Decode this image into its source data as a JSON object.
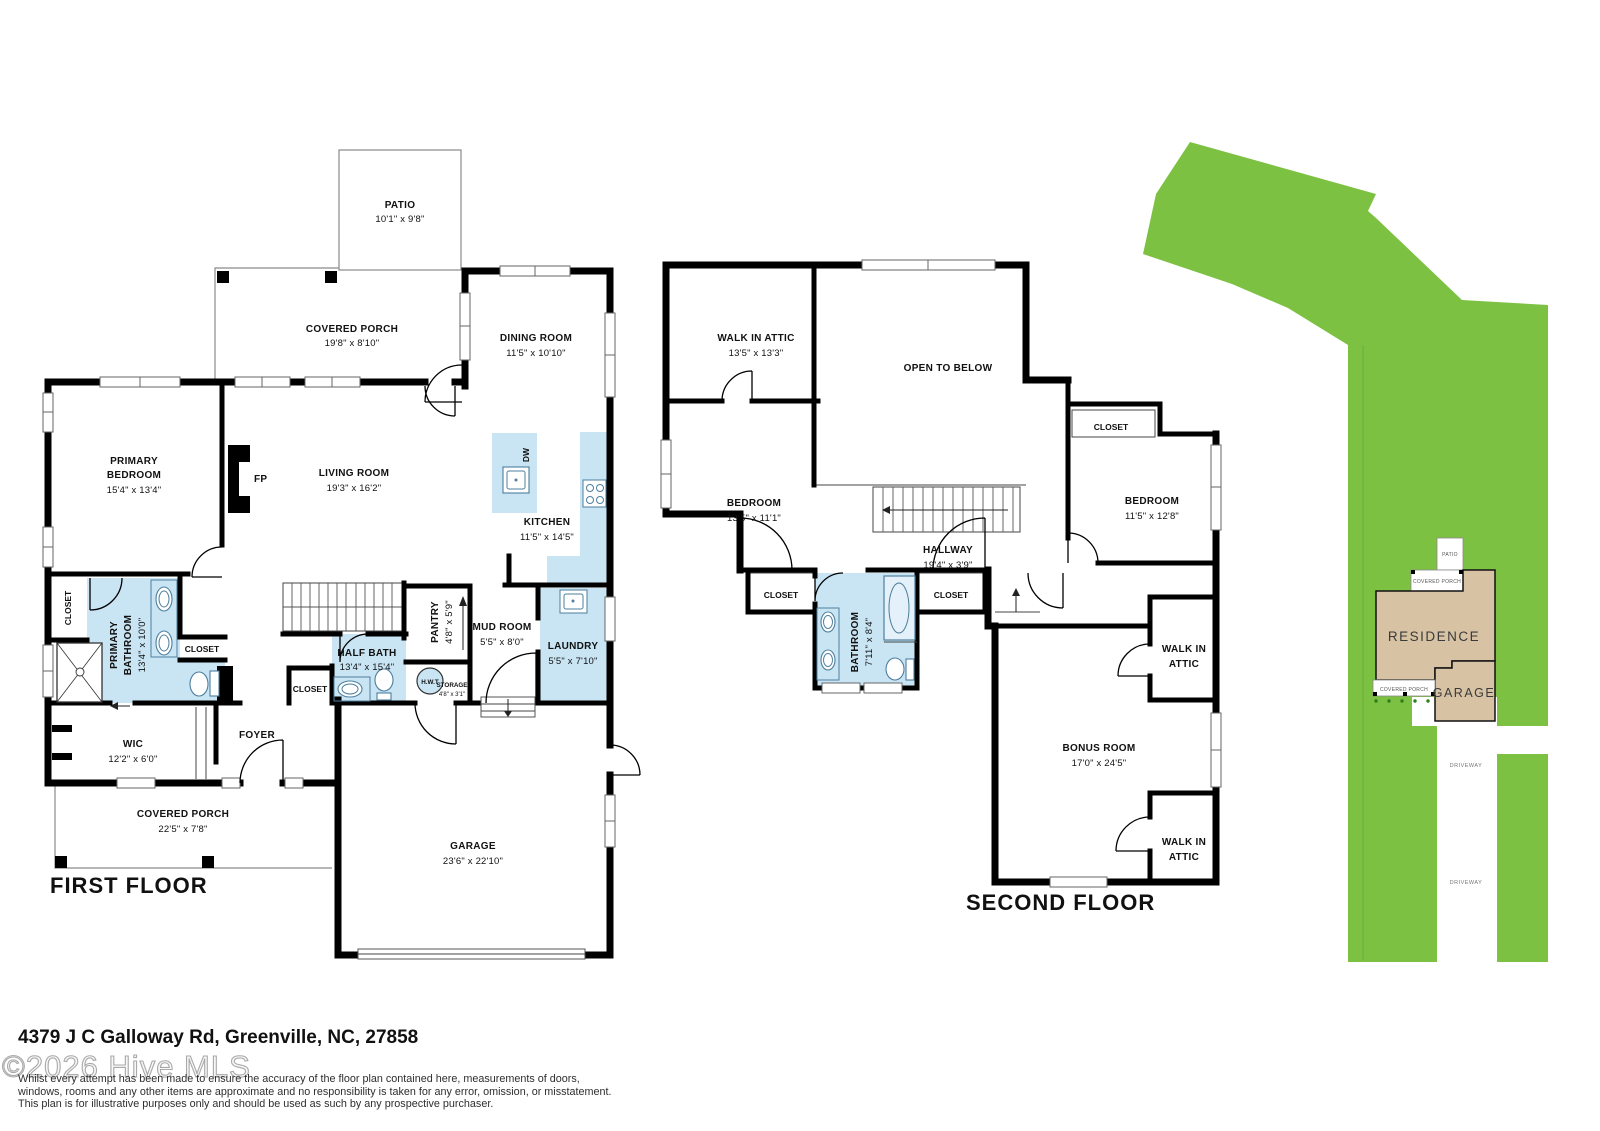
{
  "colors": {
    "accent_blue": "#c9e5f4",
    "site_green": "#7dc142",
    "building_tan": "#d7c2a4",
    "wall": "#000000"
  },
  "floor1": {
    "title": "FIRST FLOOR",
    "patio": {
      "name": "PATIO",
      "dims": "10'1\" x 9'8\""
    },
    "porch_top": {
      "name": "COVERED PORCH",
      "dims": "19'8\" x 8'10\""
    },
    "dining": {
      "name": "DINING ROOM",
      "dims": "11'5\" x 10'10\""
    },
    "primary_bedroom": {
      "name1": "PRIMARY",
      "name2": "BEDROOM",
      "dims": "15'4\" x 13'4\""
    },
    "fireplace": {
      "name": "FP"
    },
    "living": {
      "name": "LIVING ROOM",
      "dims": "19'3\" x 16'2\""
    },
    "kitchen": {
      "name": "KITCHEN",
      "dims": "11'5\" x 14'5\""
    },
    "dishwasher": {
      "name": "DW"
    },
    "closet_left": {
      "name": "CLOSET"
    },
    "primary_bath": {
      "name1": "PRIMARY",
      "name2": "BATHROOM",
      "dims": "13'4\" x 10'0\""
    },
    "closet_vanity": {
      "name": "CLOSET"
    },
    "wic": {
      "name": "WIC",
      "dims": "12'2\" x 6'0\""
    },
    "foyer": {
      "name": "FOYER"
    },
    "closet_stairs": {
      "name": "CLOSET"
    },
    "half_bath": {
      "name": "HALF BATH",
      "dims": "13'4\" x 15'4\""
    },
    "pantry": {
      "name": "PANTRY",
      "dims": "4'8\" x 5'9\""
    },
    "hwt": {
      "name": "H.W.T"
    },
    "storage": {
      "name": "STORAGE",
      "dims": "4'8\" x 3'1\""
    },
    "mud_room": {
      "name": "MUD ROOM",
      "dims": "5'5\" x 8'0\""
    },
    "laundry": {
      "name": "LAUNDRY",
      "dims": "5'5\" x 7'10\""
    },
    "porch_bottom": {
      "name": "COVERED PORCH",
      "dims": "22'5\" x 7'8\""
    },
    "garage": {
      "name": "GARAGE",
      "dims": "23'6\" x 22'10\""
    }
  },
  "floor2": {
    "title": "SECOND FLOOR",
    "attic_top": {
      "name": "WALK IN ATTIC",
      "dims": "13'5\" x 13'3\""
    },
    "open_below": {
      "name": "OPEN TO BELOW"
    },
    "bedroom_left": {
      "name": "BEDROOM",
      "dims": "13'5\" x 11'1\""
    },
    "closet_top_right": {
      "name": "CLOSET"
    },
    "bedroom_right": {
      "name": "BEDROOM",
      "dims": "11'5\" x 12'8\""
    },
    "hallway": {
      "name": "HALLWAY",
      "dims": "19'4\" x 3'9\""
    },
    "closet_hall_left": {
      "name": "CLOSET"
    },
    "bathroom": {
      "name": "BATHROOM",
      "dims": "7'11\" x 8'4\""
    },
    "closet_hall_right": {
      "name": "CLOSET"
    },
    "attic_mid": {
      "name1": "WALK IN",
      "name2": "ATTIC"
    },
    "bonus": {
      "name": "BONUS ROOM",
      "dims": "17'0\" x 24'5\""
    },
    "attic_bottom": {
      "name1": "WALK IN",
      "name2": "ATTIC"
    }
  },
  "site": {
    "residence": "RESIDENCE",
    "garage": "GARAGE",
    "patio": "PATIO",
    "porch_top": "COVERED PORCH",
    "porch_bottom": "COVERED PORCH",
    "driveway_upper": "DRIVEWAY",
    "driveway_lower": "DRIVEWAY"
  },
  "footer": {
    "address": "4379 J C Galloway Rd, Greenville, NC, 27858",
    "watermark": "©2026 Hive MLS",
    "disclaimer_line1": "Whilst every attempt has been made to ensure the accuracy of the floor plan contained here, measurements of doors,",
    "disclaimer_line2": "windows, rooms and any other items are approximate and no responsibility is taken for any error, omission, or misstatement.",
    "disclaimer_line3": "This plan is for illustrative purposes only and should be used as such by any prospective purchaser."
  }
}
